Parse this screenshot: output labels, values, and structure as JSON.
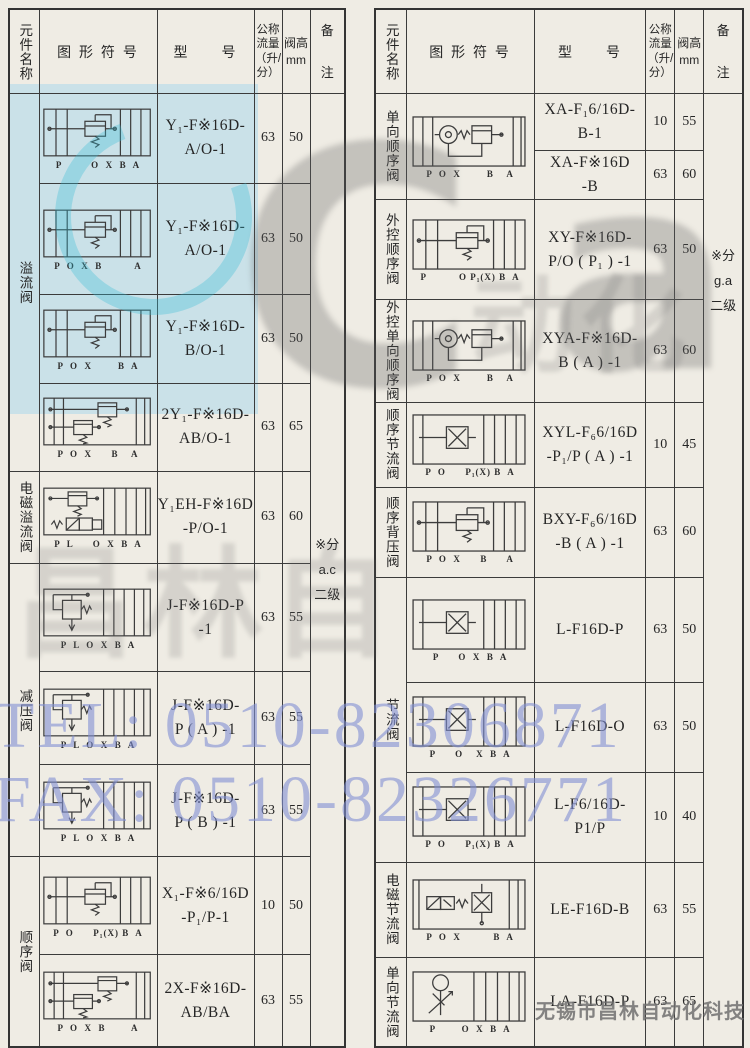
{
  "header": {
    "name": "元件名称",
    "symbol": "图 形 符 号",
    "model": "型　　号",
    "flow": "公称\n流量\n（升/\n分）",
    "height": "阀高\nmm",
    "remark": "备\n注"
  },
  "watermarks": {
    "tel": "TEL: 0510-82306871",
    "fax": "FAX: 0510-82326771",
    "logo_c": "C",
    "logo_air": "air",
    "logo_cn_left": "昌林自",
    "logo_cn_right": "动化",
    "accent_teal": "#37bed7",
    "accent_blue": "#808fd4",
    "tint_blue": "#96d2ee"
  },
  "footer": "无锡市昌林自动化科技",
  "left": {
    "remark": "※分\na.c\n二级",
    "rows": [
      {
        "name": "溢流阀",
        "model": "Y₁-F※16D-\nA/O-1",
        "flow": "63",
        "height": "50",
        "ports": "P         O  X  B  A",
        "sym": "#sym-relief"
      },
      {
        "model": "Y₁-F※16D-\nA/O-1",
        "flow": "63",
        "height": "50",
        "ports": "P  O  X  B          A",
        "sym": "#sym-relief"
      },
      {
        "model": "Y₁-F※16D-\nB/O-1",
        "flow": "63",
        "height": "50",
        "ports": "P  O  X        B  A",
        "sym": "#sym-relief"
      },
      {
        "model": "2Y₁-F※16D-\nAB/O-1",
        "flow": "63",
        "height": "65",
        "ports": "P  O  X      B    A",
        "sym": "#sym-relief2"
      },
      {
        "name": "电磁溢流阀",
        "model": "Y₁EH-F※16D\n-P/O-1",
        "flow": "63",
        "height": "60",
        "ports": "P  L      O  X  B  A",
        "sym": "#sym-sol-relief"
      },
      {
        "name": "减压阀",
        "model": "J-F※16D-P\n-1",
        "flow": "63",
        "height": "55",
        "ports": "P  L  O  X  B  A",
        "sym": "#sym-reduce"
      },
      {
        "model": "J-F※16D-\nP ( A ) -1",
        "flow": "63",
        "height": "55",
        "ports": "P  L  O  X  B  A",
        "sym": "#sym-reduce"
      },
      {
        "model": "J-F※16D-\nP ( B ) -1",
        "flow": "63",
        "height": "55",
        "ports": "P  L  O  X  B  A",
        "sym": "#sym-reduce"
      },
      {
        "name": "顺序阀",
        "model": "X₁-F※6/16D\n-P₁/P-1",
        "flow": "10",
        "height": "50",
        "ports": "P  O      P₁(X) B  A",
        "sym": "#sym-relief"
      },
      {
        "model": "2X-F※16D-\nAB/BA",
        "flow": "63",
        "height": "55",
        "ports": "P  O  X  B        A",
        "sym": "#sym-relief2"
      }
    ]
  },
  "right": {
    "remark": "※分\ng.a\n二级",
    "rows": [
      {
        "name": "单向顺序阀",
        "model": "XA-F₁6/16D-\nB-1",
        "flow": "10",
        "height": "55",
        "ports": "P  O  X        B    A",
        "sym": "#sym-check"
      },
      {
        "model": "XA-F※16D\n-B",
        "flow": "63",
        "height": "60"
      },
      {
        "name": "外控顺序阀",
        "model": "XY-F※16D-\nP/O ( P₁ ) -1",
        "flow": "63",
        "height": "50",
        "ports": "P          O P₁(X) B  A",
        "sym": "#sym-relief"
      },
      {
        "name": "外控单向顺序阀",
        "model": "XYA-F※16D-\nB ( A ) -1",
        "flow": "63",
        "height": "60",
        "ports": "P  O  X        B    A",
        "sym": "#sym-check"
      },
      {
        "name": "顺序节流阀",
        "model": "XYL-F₆6/16D\n-P₁/P ( A ) -1",
        "flow": "10",
        "height": "45",
        "ports": "P  O      P₁(X) B  A",
        "sym": "#sym-throttle"
      },
      {
        "name": "顺序背压阀",
        "model": "BXY-F₆6/16D\n-B ( A ) -1",
        "flow": "63",
        "height": "60",
        "ports": "P  O  X      B      A",
        "sym": "#sym-relief"
      },
      {
        "name": "节流阀",
        "model": "L-F16D-P",
        "flow": "63",
        "height": "50",
        "ports": "P      O  X  B  A",
        "sym": "#sym-throttle"
      },
      {
        "model": "L-F16D-O",
        "flow": "63",
        "height": "50",
        "ports": "P      O    X  B  A",
        "sym": "#sym-throttle"
      },
      {
        "model": "L-F6/16D-\nP1/P",
        "flow": "10",
        "height": "40",
        "ports": "P  O      P₁(X) B  A",
        "sym": "#sym-throttle"
      },
      {
        "name": "电磁节流阀",
        "model": "LE-F16D-B",
        "flow": "63",
        "height": "55",
        "ports": "P  O  X          B  A",
        "sym": "#sym-sol-throttle"
      },
      {
        "name": "单向节流阀",
        "model": "LA-F16D-P",
        "flow": "63",
        "height": "65",
        "ports": "P        O  X  B  A",
        "sym": "#sym-check-arrow"
      }
    ]
  }
}
